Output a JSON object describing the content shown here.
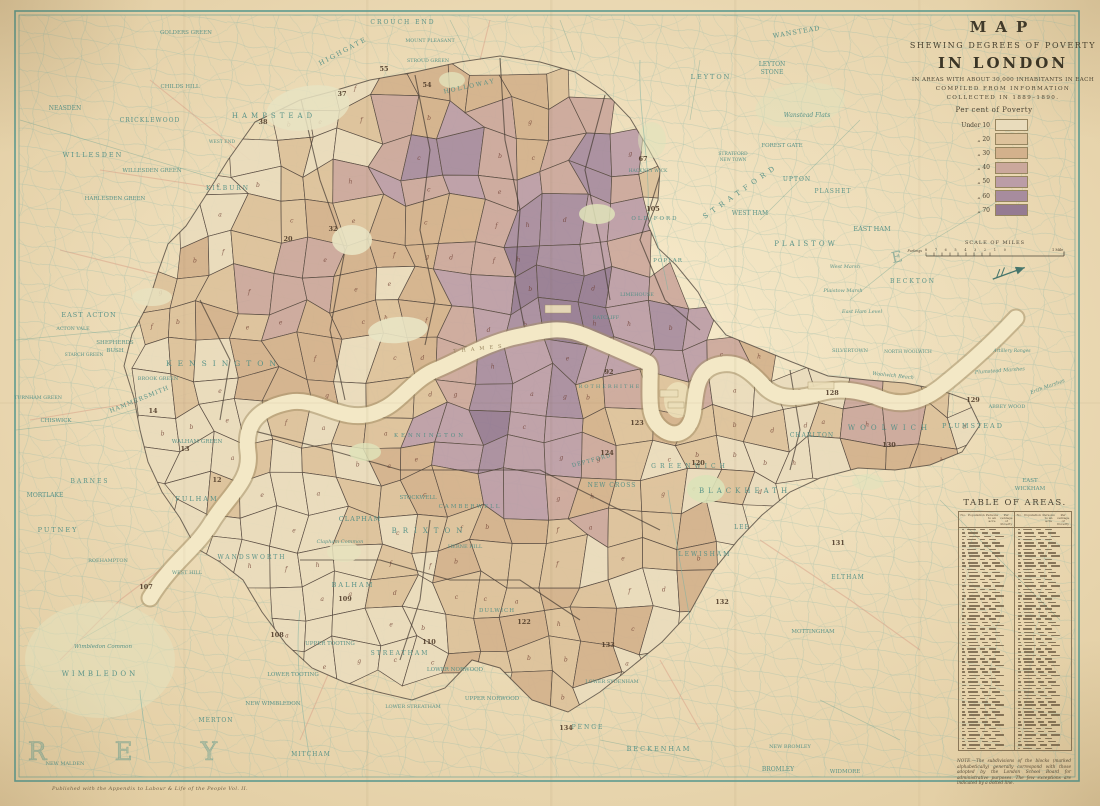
{
  "title_block": {
    "line1": "MAP",
    "line2": "SHEWING DEGREES OF POVERTY",
    "line3": "IN LONDON",
    "line4": "IN AREAS WITH ABOUT 30,000 INHABITANTS IN EACH",
    "line5": "COMPILED FROM INFORMATION",
    "line6": "COLLECTED IN 1889–1890."
  },
  "legend": {
    "heading": "Per cent of Poverty",
    "items": [
      {
        "label": "Under 10",
        "color": "#e9dcbc"
      },
      {
        "label": "„  20",
        "color": "#ddc29b"
      },
      {
        "label": "„  30",
        "color": "#d3b18c"
      },
      {
        "label": "„  40",
        "color": "#cba89c"
      },
      {
        "label": "„  50",
        "color": "#bb9da7"
      },
      {
        "label": "„  60",
        "color": "#a78c9e"
      },
      {
        "label": "„  70",
        "color": "#957b92"
      }
    ]
  },
  "scale_bar": {
    "heading": "SCALE OF MILES",
    "furlongs_label": "Furlongs",
    "furlong_ticks": "8 7 6 5 4 3 2 1 0",
    "mile_label": "1 Mile"
  },
  "table": {
    "title": "TABLE OF AREAS.",
    "columns": [
      "No.",
      "Population",
      "Persons to an acre",
      "Per centage of Poverty"
    ],
    "note": "NOTE.—The subdivisions of the blocks (marked alphabetically) generally correspond with those adopted by the London School Board for administrative purposes. The few exceptions are indicated by a dotted line."
  },
  "footer": {
    "publisher": "Published with the Appendix to Labour & Life of the People Vol. II."
  },
  "map": {
    "label_color": "#4f8e85",
    "county_label": "SURREY",
    "essex_letter": "E",
    "river_label": "THAMES",
    "palette": [
      "#e9dcbc",
      "#ddc29b",
      "#d3b18c",
      "#cba89c",
      "#bb9da7",
      "#a78c9e",
      "#957b92"
    ],
    "labels": [
      {
        "t": "NEASDEN",
        "x": 65,
        "y": 110,
        "s": 6
      },
      {
        "t": "CRICKLEWOOD",
        "x": 150,
        "y": 122,
        "s": 6,
        "ls": 1
      },
      {
        "t": "WILLESDEN",
        "x": 93,
        "y": 157,
        "s": 6.5,
        "ls": 2
      },
      {
        "t": "WILLESDEN GREEN",
        "x": 152,
        "y": 172,
        "s": 5.5
      },
      {
        "t": "HARLESDEN GREEN",
        "x": 115,
        "y": 200,
        "s": 5.5
      },
      {
        "t": "KILBURN",
        "x": 228,
        "y": 190,
        "s": 6,
        "ls": 2
      },
      {
        "t": "WEST END",
        "x": 222,
        "y": 143,
        "s": 4.5
      },
      {
        "t": "GOLDERS GREEN",
        "x": 186,
        "y": 34,
        "s": 5.5
      },
      {
        "t": "CHILDS HILL",
        "x": 180,
        "y": 88,
        "s": 5.5
      },
      {
        "t": "CROUCH END",
        "x": 403,
        "y": 24,
        "s": 6,
        "ls": 2
      },
      {
        "t": "HIGHGATE",
        "x": 344,
        "y": 53,
        "s": 6.5,
        "ls": 2,
        "r": -28
      },
      {
        "t": "HAMPSTEAD",
        "x": 274,
        "y": 118,
        "s": 7,
        "ls": 4
      },
      {
        "t": "MOUNT PLEASANT",
        "x": 430,
        "y": 42,
        "s": 4.8
      },
      {
        "t": "STROUD GREEN",
        "x": 428,
        "y": 62,
        "s": 4.8
      },
      {
        "t": "HOLLOWAY",
        "x": 470,
        "y": 88,
        "s": 6,
        "ls": 2,
        "r": -12
      },
      {
        "t": "WANSTEAD",
        "x": 797,
        "y": 34,
        "s": 6.5,
        "r": -10,
        "ls": 1
      },
      {
        "t": "LEYTON",
        "x": 711,
        "y": 79,
        "s": 6.5,
        "ls": 2
      },
      {
        "t": "LEYTON",
        "x": 772,
        "y": 66,
        "s": 6
      },
      {
        "t": "STONE",
        "x": 772,
        "y": 74,
        "s": 6
      },
      {
        "t": "Wanstead Flats",
        "x": 807,
        "y": 117,
        "s": 6,
        "i": 1
      },
      {
        "t": "FOREST GATE",
        "x": 782,
        "y": 147,
        "s": 5.5
      },
      {
        "t": "STRATFORD",
        "x": 733,
        "y": 155,
        "s": 4.5
      },
      {
        "t": "NEW TOWN",
        "x": 733,
        "y": 161,
        "s": 4.2
      },
      {
        "t": "STRATFORD",
        "x": 742,
        "y": 193,
        "s": 7,
        "ls": 5,
        "r": -35
      },
      {
        "t": "UPTON",
        "x": 797,
        "y": 181,
        "s": 6,
        "ls": 1
      },
      {
        "t": "PLASHET",
        "x": 833,
        "y": 193,
        "s": 6,
        "ls": 1
      },
      {
        "t": "WEST HAM",
        "x": 750,
        "y": 215,
        "s": 6
      },
      {
        "t": "EAST HAM",
        "x": 872,
        "y": 231,
        "s": 6.5
      },
      {
        "t": "PLAISTOW",
        "x": 806,
        "y": 246,
        "s": 7,
        "ls": 3
      },
      {
        "t": "BECKTON",
        "x": 913,
        "y": 283,
        "s": 6,
        "ls": 2
      },
      {
        "t": "West Marsh",
        "x": 845,
        "y": 268,
        "s": 5,
        "i": 1
      },
      {
        "t": "Plaistow Marsh",
        "x": 843,
        "y": 292,
        "s": 5,
        "i": 1
      },
      {
        "t": "East Ham Level",
        "x": 862,
        "y": 313,
        "s": 5,
        "i": 1
      },
      {
        "t": "SILVERTOWN",
        "x": 850,
        "y": 352,
        "s": 5
      },
      {
        "t": "NORTH WOOLWICH",
        "x": 908,
        "y": 353,
        "s": 4.5
      },
      {
        "t": "Woolwich Reach",
        "x": 893,
        "y": 377,
        "s": 5,
        "i": 1,
        "r": 6
      },
      {
        "t": "CHARLTON",
        "x": 812,
        "y": 437,
        "s": 6,
        "ls": 1
      },
      {
        "t": "WOOLWICH",
        "x": 890,
        "y": 430,
        "s": 7,
        "ls": 5
      },
      {
        "t": "PLUMSTEAD",
        "x": 973,
        "y": 428,
        "s": 6.5,
        "ls": 2
      },
      {
        "t": "ABBEY WOOD",
        "x": 1007,
        "y": 408,
        "s": 5
      },
      {
        "t": "EAST",
        "x": 1030,
        "y": 482,
        "s": 5.5
      },
      {
        "t": "WICKHAM",
        "x": 1030,
        "y": 490,
        "s": 5.5
      },
      {
        "t": "Plumstead Marshes",
        "x": 1000,
        "y": 372,
        "s": 5,
        "i": 1,
        "r": -4
      },
      {
        "t": "Erith Marshes",
        "x": 1048,
        "y": 388,
        "s": 5,
        "i": 1,
        "r": -20
      },
      {
        "t": "Artillery Ranges",
        "x": 1012,
        "y": 352,
        "s": 4.5,
        "i": 1
      },
      {
        "t": "EAST ACTON",
        "x": 89,
        "y": 317,
        "s": 6.5,
        "ls": 1
      },
      {
        "t": "ACTON VALE",
        "x": 73,
        "y": 330,
        "s": 4.8
      },
      {
        "t": "SHEPHERDS",
        "x": 115,
        "y": 344,
        "s": 5.5
      },
      {
        "t": "BUSH",
        "x": 115,
        "y": 352,
        "s": 5.5
      },
      {
        "t": "STARCH GREEN",
        "x": 84,
        "y": 356,
        "s": 4.5
      },
      {
        "t": "KENSINGTON",
        "x": 224,
        "y": 366,
        "s": 7.5,
        "ls": 6
      },
      {
        "t": "BROOK GREEN",
        "x": 158,
        "y": 380,
        "s": 5
      },
      {
        "t": "HAMMERSMITH",
        "x": 140,
        "y": 401,
        "s": 6,
        "r": -22,
        "ls": 1
      },
      {
        "t": "TURNHAM GREEN",
        "x": 38,
        "y": 399,
        "s": 4.8
      },
      {
        "t": "CHISWICK",
        "x": 56,
        "y": 422,
        "s": 5.5
      },
      {
        "t": "WALHAM GREEN",
        "x": 197,
        "y": 443,
        "s": 5.5
      },
      {
        "t": "BARNES",
        "x": 90,
        "y": 483,
        "s": 6,
        "ls": 2
      },
      {
        "t": "MORTLAKE",
        "x": 45,
        "y": 497,
        "s": 6
      },
      {
        "t": "PUTNEY",
        "x": 58,
        "y": 532,
        "s": 6.5,
        "ls": 2
      },
      {
        "t": "ROEHAMPTON",
        "x": 108,
        "y": 562,
        "s": 5
      },
      {
        "t": "Wimbledon Common",
        "x": 103,
        "y": 648,
        "s": 5.5,
        "i": 1
      },
      {
        "t": "WIMBLEDON",
        "x": 100,
        "y": 676,
        "s": 7,
        "ls": 3
      },
      {
        "t": "MERTON",
        "x": 216,
        "y": 722,
        "s": 6,
        "ls": 1
      },
      {
        "t": "NEW WIMBLEDON",
        "x": 273,
        "y": 705,
        "s": 5.5
      },
      {
        "t": "MITCHAM",
        "x": 311,
        "y": 756,
        "s": 6,
        "ls": 1
      },
      {
        "t": "NEW MALDEN",
        "x": 65,
        "y": 765,
        "s": 5
      },
      {
        "t": "FULHAM",
        "x": 197,
        "y": 501,
        "s": 6.5,
        "ls": 2
      },
      {
        "t": "WANDSWORTH",
        "x": 252,
        "y": 559,
        "s": 6,
        "ls": 2
      },
      {
        "t": "WEST HILL",
        "x": 187,
        "y": 574,
        "s": 5
      },
      {
        "t": "CLAPHAM",
        "x": 360,
        "y": 521,
        "s": 6.5,
        "ls": 1
      },
      {
        "t": "Clapham Common",
        "x": 340,
        "y": 543,
        "s": 5,
        "i": 1
      },
      {
        "t": "STOCKWELL",
        "x": 418,
        "y": 499,
        "s": 5.5
      },
      {
        "t": "BRIXTON",
        "x": 430,
        "y": 533,
        "s": 7,
        "ls": 6
      },
      {
        "t": "BALHAM",
        "x": 353,
        "y": 587,
        "s": 6.5,
        "ls": 2
      },
      {
        "t": "UPPER TOOTING",
        "x": 330,
        "y": 645,
        "s": 5.5
      },
      {
        "t": "LOWER TOOTING",
        "x": 293,
        "y": 676,
        "s": 5.5
      },
      {
        "t": "STREATHAM",
        "x": 400,
        "y": 655,
        "s": 6,
        "ls": 2
      },
      {
        "t": "LOWER STREATHAM",
        "x": 413,
        "y": 708,
        "s": 5
      },
      {
        "t": "HERNE HILL",
        "x": 465,
        "y": 548,
        "s": 5
      },
      {
        "t": "DULWICH",
        "x": 497,
        "y": 612,
        "s": 5.5,
        "ls": 1
      },
      {
        "t": "LOWER NORWOOD",
        "x": 455,
        "y": 671,
        "s": 5.5
      },
      {
        "t": "UPPER NORWOOD",
        "x": 492,
        "y": 700,
        "s": 5.5
      },
      {
        "t": "NEW CROSS",
        "x": 612,
        "y": 487,
        "s": 6,
        "ls": 1
      },
      {
        "t": "BLACKHEATH",
        "x": 745,
        "y": 493,
        "s": 7,
        "ls": 4
      },
      {
        "t": "LEE",
        "x": 742,
        "y": 529,
        "s": 6,
        "ls": 1
      },
      {
        "t": "LEWISHAM",
        "x": 705,
        "y": 556,
        "s": 6,
        "ls": 2
      },
      {
        "t": "ELTHAM",
        "x": 848,
        "y": 579,
        "s": 6,
        "ls": 1
      },
      {
        "t": "MOTTINGHAM",
        "x": 813,
        "y": 633,
        "s": 5.5
      },
      {
        "t": "LOWER SYDENHAM",
        "x": 612,
        "y": 683,
        "s": 5
      },
      {
        "t": "PENGE",
        "x": 588,
        "y": 729,
        "s": 6,
        "ls": 2
      },
      {
        "t": "BECKENHAM",
        "x": 659,
        "y": 751,
        "s": 6.5,
        "ls": 2
      },
      {
        "t": "NEW BROMLEY",
        "x": 790,
        "y": 748,
        "s": 5
      },
      {
        "t": "BROMLEY",
        "x": 778,
        "y": 771,
        "s": 6
      },
      {
        "t": "WIDMORE",
        "x": 845,
        "y": 773,
        "s": 5.5
      },
      {
        "t": "LIMEHOUSE",
        "x": 637,
        "y": 296,
        "s": 5
      },
      {
        "t": "RATCLIFF",
        "x": 606,
        "y": 319,
        "s": 5
      },
      {
        "t": "ROTHERHITHE",
        "x": 610,
        "y": 388,
        "s": 5,
        "ls": 2
      },
      {
        "t": "DEPTFORD",
        "x": 592,
        "y": 462,
        "s": 5.5,
        "r": -15,
        "ls": 1
      },
      {
        "t": "GREENWICH",
        "x": 690,
        "y": 468,
        "s": 6,
        "ls": 4
      },
      {
        "t": "KENNINGTON",
        "x": 430,
        "y": 437,
        "s": 5.5,
        "ls": 3
      },
      {
        "t": "CAMBERWELL",
        "x": 470,
        "y": 508,
        "s": 5.5,
        "ls": 2
      },
      {
        "t": "POPLAR",
        "x": 668,
        "y": 262,
        "s": 5.5,
        "ls": 1
      },
      {
        "t": "OLD FORD",
        "x": 655,
        "y": 220,
        "s": 5.5,
        "ls": 2
      },
      {
        "t": "HACKNEY WICK",
        "x": 648,
        "y": 172,
        "s": 4.5
      },
      {
        "t": "THAMES",
        "x": 480,
        "y": 350,
        "s": 5,
        "ls": 5,
        "r": -6,
        "c": "#8f7b55"
      }
    ],
    "area_numbers": [
      {
        "n": "107",
        "x": 146,
        "y": 589
      },
      {
        "n": "108",
        "x": 277,
        "y": 637
      },
      {
        "n": "109",
        "x": 345,
        "y": 601
      },
      {
        "n": "110",
        "x": 429,
        "y": 644
      },
      {
        "n": "122",
        "x": 524,
        "y": 624
      },
      {
        "n": "133",
        "x": 608,
        "y": 647
      },
      {
        "n": "134",
        "x": 566,
        "y": 730
      },
      {
        "n": "131",
        "x": 838,
        "y": 545
      },
      {
        "n": "132",
        "x": 722,
        "y": 604
      },
      {
        "n": "130",
        "x": 889,
        "y": 447
      },
      {
        "n": "129",
        "x": 973,
        "y": 402
      },
      {
        "n": "128",
        "x": 832,
        "y": 395
      },
      {
        "n": "120",
        "x": 698,
        "y": 465
      },
      {
        "n": "123",
        "x": 637,
        "y": 425
      },
      {
        "n": "124",
        "x": 607,
        "y": 455
      },
      {
        "n": "105",
        "x": 653,
        "y": 211
      },
      {
        "n": "92",
        "x": 609,
        "y": 374
      },
      {
        "n": "55",
        "x": 384,
        "y": 71
      },
      {
        "n": "54",
        "x": 427,
        "y": 87
      },
      {
        "n": "37",
        "x": 342,
        "y": 96
      },
      {
        "n": "38",
        "x": 263,
        "y": 124
      },
      {
        "n": "67",
        "x": 643,
        "y": 161
      },
      {
        "n": "32",
        "x": 333,
        "y": 231
      },
      {
        "n": "20",
        "x": 288,
        "y": 241
      },
      {
        "n": "14",
        "x": 153,
        "y": 413
      },
      {
        "n": "13",
        "x": 185,
        "y": 451
      },
      {
        "n": "12",
        "x": 217,
        "y": 482
      }
    ]
  }
}
